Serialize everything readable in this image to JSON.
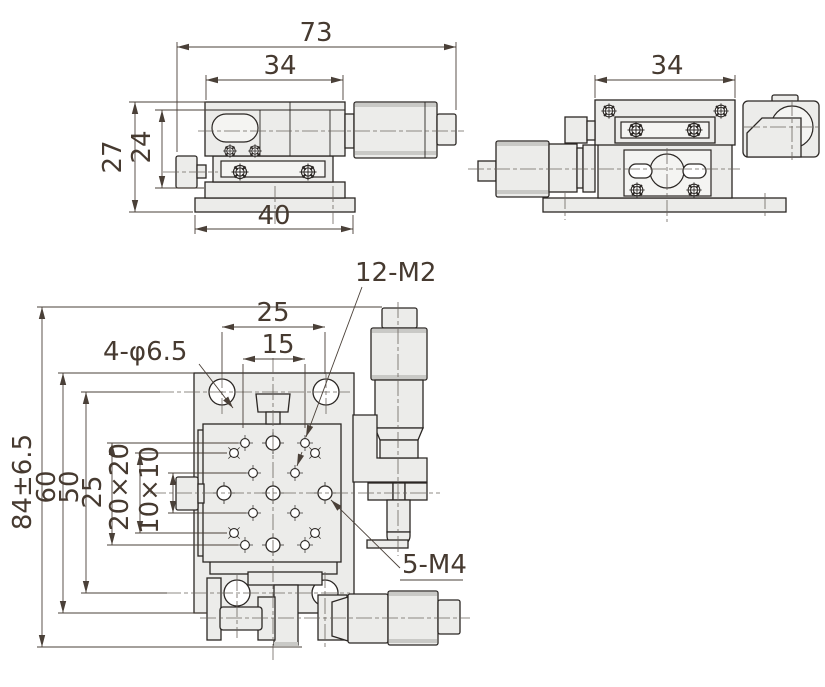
{
  "colors": {
    "background": "#ffffff",
    "line": "#2b2724",
    "dimension_line": "#4a4038",
    "text": "#463a30",
    "fill_body": "#ececea",
    "fill_light": "#f4f4f2",
    "fill_band": "#c9c9c6"
  },
  "views": {
    "front": {
      "dimensions": {
        "overall_width": "73",
        "carriage_width": "34",
        "overall_height": "27",
        "body_height": "24",
        "base_width": "40"
      }
    },
    "side": {
      "dimensions": {
        "carriage_width": "34"
      }
    },
    "plan": {
      "dimensions": {
        "hole_spacing_horizontal": "25",
        "inner_spacing_horizontal": "15",
        "overall_length": "84±6.5",
        "base_length": "60",
        "hole_spacing_vertical": "50",
        "pattern_height": "25",
        "outer_grid": "20×20",
        "inner_grid": "10×10"
      },
      "callouts": {
        "corner_holes": "4-φ6.5",
        "thread_holes_small": "12-M2",
        "thread_holes_large": "5-M4"
      }
    }
  }
}
